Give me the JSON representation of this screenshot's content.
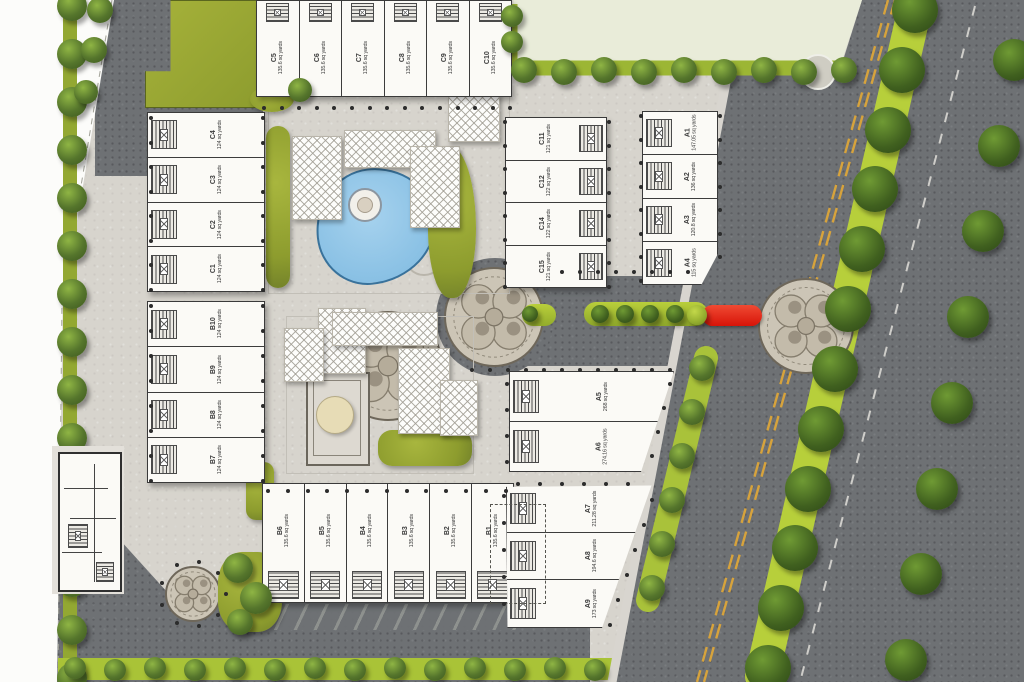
{
  "plan_type": "residential-site-plan",
  "area_unit": "sq yards",
  "colors": {
    "asphalt": "#6e7174",
    "walkway": "#d7d4cd",
    "plot_white": "#fbfaf6",
    "olive_green": "#8d9c2e",
    "bright_green": "#aecb37",
    "tree_dark": "#40601f",
    "pool_blue": "#90c5e7",
    "marker_red": "#e3241a",
    "lane_yellow": "#d7a33c",
    "open_plot": "#e9ecd9"
  },
  "plots": {
    "top_row": [
      {
        "id": "C5",
        "area": "135.6 sq yards"
      },
      {
        "id": "C6",
        "area": "135.6 sq yards"
      },
      {
        "id": "C7",
        "area": "135.6 sq yards"
      },
      {
        "id": "C8",
        "area": "135.6 sq yards"
      },
      {
        "id": "C9",
        "area": "135.6 sq yards"
      },
      {
        "id": "C10",
        "area": "135.6 sq yards"
      }
    ],
    "upper_left_column": [
      {
        "id": "C4",
        "area": "124 sq yards"
      },
      {
        "id": "C3",
        "area": "124 sq yards"
      },
      {
        "id": "C2",
        "area": "124 sq yards"
      },
      {
        "id": "C1",
        "area": "124 sq yards"
      }
    ],
    "middle_column": [
      {
        "id": "C11",
        "area": "121 sq yards"
      },
      {
        "id": "C12",
        "area": "122 sq yards"
      },
      {
        "id": "C14",
        "area": "122 sq yards"
      },
      {
        "id": "C15",
        "area": "121 sq yards"
      }
    ],
    "right_column": [
      {
        "id": "A1",
        "area": "147.05 sq yards"
      },
      {
        "id": "A2",
        "area": "136 sq yards"
      },
      {
        "id": "A3",
        "area": "120.8 sq yards"
      },
      {
        "id": "A4",
        "area": "115 sq yards"
      }
    ],
    "lower_left_column": [
      {
        "id": "B10",
        "area": "124 sq yards"
      },
      {
        "id": "B9",
        "area": "124 sq yards"
      },
      {
        "id": "B8",
        "area": "124 sq yards"
      },
      {
        "id": "B7",
        "area": "124 sq yards"
      }
    ],
    "bottom_row": [
      {
        "id": "B6",
        "area": "135.6 sq yards"
      },
      {
        "id": "B5",
        "area": "135.6 sq yards"
      },
      {
        "id": "B4",
        "area": "135.6 sq yards"
      },
      {
        "id": "B3",
        "area": "135.6 sq yards"
      },
      {
        "id": "B2",
        "area": "135.6 sq yards"
      },
      {
        "id": "B1",
        "area": "135.6 sq yards"
      }
    ],
    "east_block_upper": [
      {
        "id": "A5",
        "area": "268 sq yards"
      },
      {
        "id": "A6",
        "area": "274.16 sq yards"
      }
    ],
    "east_block_lower": [
      {
        "id": "A7",
        "area": "211.28 sq yards"
      },
      {
        "id": "A8",
        "area": "194.6 sq yards"
      },
      {
        "id": "A9",
        "area": "173 sq yards"
      }
    ]
  }
}
